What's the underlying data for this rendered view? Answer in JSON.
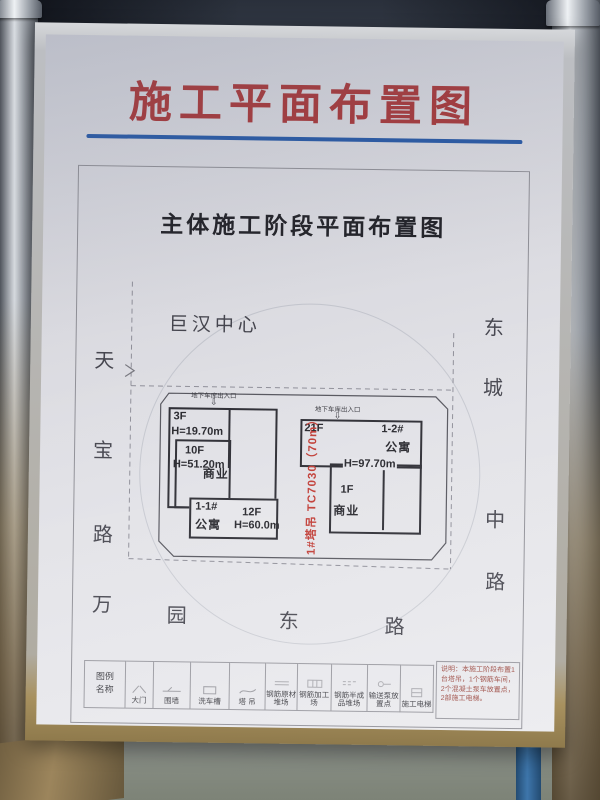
{
  "board": {
    "title": "施工平面布置图",
    "subtitle": "主体施工阶段平面布置图"
  },
  "plan": {
    "center_label": "巨汉中心",
    "roads": {
      "left": [
        "天",
        "宝",
        "路"
      ],
      "bottom": [
        "万",
        "园",
        "东",
        "路"
      ],
      "right": [
        "东",
        "城",
        "中",
        "路"
      ]
    },
    "entrance_label": "地下车库出入口",
    "entrance_arrow": "⇩",
    "crane_label": "1#塔吊 TC7030（70m）",
    "buildings": {
      "left": {
        "podium_floors": "3F",
        "podium_height": "H=19.70m",
        "tower_floors": "10F",
        "tower_height": "H=51.20m",
        "use": "商业",
        "wing_name": "1-1#",
        "wing_use": "公寓",
        "wing_floors": "12F",
        "wing_height": "H=60.0m"
      },
      "right": {
        "tower_floors": "21F",
        "name": "1-2#",
        "use": "公寓",
        "height": "H=97.70m",
        "podium_floors": "1F",
        "podium_use": "商业"
      }
    }
  },
  "legend": {
    "header_line1": "图例",
    "header_line2": "名称",
    "items": [
      {
        "label": "大门"
      },
      {
        "label": "围墙"
      },
      {
        "label": "洗车槽"
      },
      {
        "label": "塔 吊"
      },
      {
        "label": "钢筋原材堆场"
      },
      {
        "label": "钢筋加工场"
      },
      {
        "label": "钢筋半成品堆场"
      },
      {
        "label": "输送泵放置点"
      },
      {
        "label": "施工电梯"
      }
    ],
    "notes": "说明：本施工阶段布置1台塔吊，1个钢筋车间，2个混凝土泵车放置点，2部施工电梯。"
  },
  "colors": {
    "title_red": "#a63a3c",
    "rule_blue": "#2a5aa5",
    "crane_red": "#c03a33"
  }
}
